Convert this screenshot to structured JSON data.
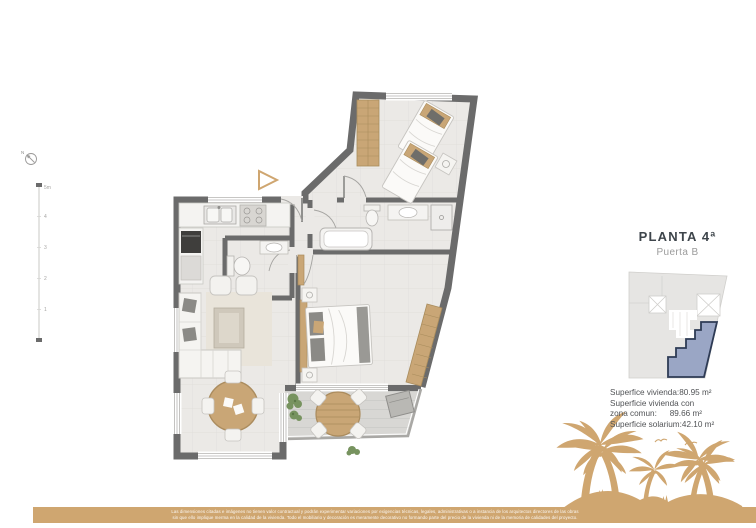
{
  "header": {
    "title": "PLANTA 4ª",
    "subtitle": "Puerta B"
  },
  "surfaces": {
    "line1_label": "Superfice vivienda:",
    "line1_value": "80.95 m²",
    "line2_label": "Superficie vivienda con",
    "line3_label": "zona comun:",
    "line3_value": "89.66 m²",
    "line4_label": "Superficie solarium:",
    "line4_value": "42.10 m²"
  },
  "scale_bar": {
    "labels": [
      "5m",
      "4",
      "3",
      "2",
      "1"
    ]
  },
  "compass": {
    "north_label": "N"
  },
  "disclaimer": {
    "line1": "Las dimensiones citadas e imágenes no tienen valor contractual y podrán experimentar variaciones por exigencias técnicas, legales, administrativas o a instancia de los arquitectos directores de las obras",
    "line2": "sin que ello implique merma en la calidad de la vivienda. Todo el mobiliario y decoración es meramente decorativo no formando parte del precio de la vivienda ni de la memoria de calidades del proyecto."
  },
  "colors": {
    "accent_tan": "#CFA670",
    "wall_gray": "#6B6B6B",
    "key_unit_fill": "#9AA6C5",
    "key_unit_border": "#2E3B55",
    "title_color": "#3E454B",
    "subtitle_gray": "#9B9B9B"
  }
}
